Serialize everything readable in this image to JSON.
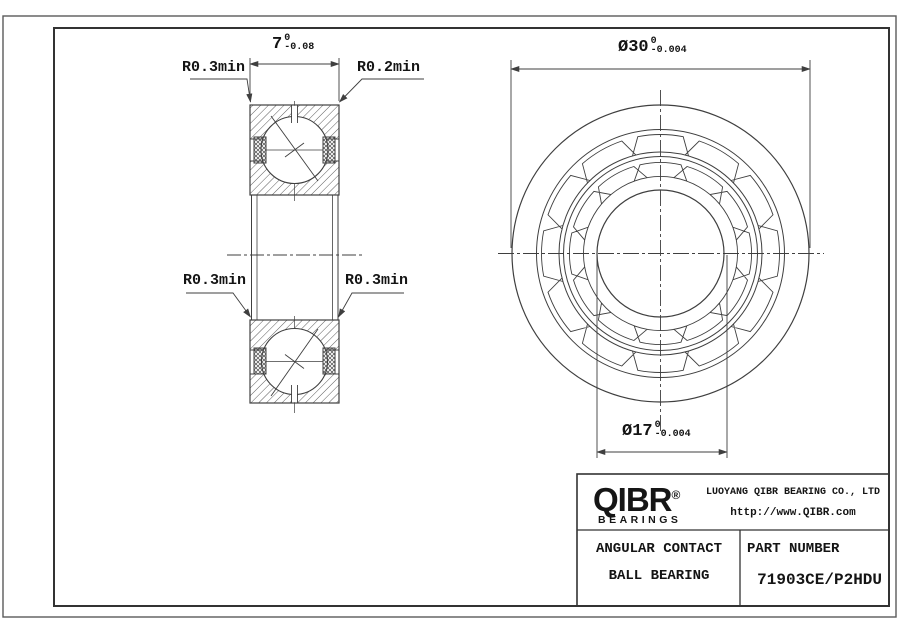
{
  "drawing": {
    "dims": {
      "width": {
        "value": "7",
        "tol_upper": "0",
        "tol_lower": "-0.08"
      },
      "outer_diameter": {
        "value": "Ø30",
        "tol_upper": "0",
        "tol_lower": "-0.004"
      },
      "bore_diameter": {
        "value": "Ø17",
        "tol_upper": "0",
        "tol_lower": "-0.004"
      }
    },
    "labels": {
      "r_top_left": "R0.3min",
      "r_top_right": "R0.2min",
      "r_mid_left": "R0.3min",
      "r_mid_right": "R0.3min"
    }
  },
  "title_block": {
    "logo_text": "QIBR",
    "logo_registered": "®",
    "logo_sub": "BEARINGS",
    "company": "LUOYANG QIBR BEARING CO., LTD",
    "website": "http://www.QIBR.com",
    "product_line1": "ANGULAR CONTACT",
    "product_line2": "BALL BEARING",
    "part_number_label": "PART NUMBER",
    "part_number": "71903CE/P2HDU"
  },
  "colors": {
    "line": "#3f3f3f",
    "text": "#141414"
  }
}
